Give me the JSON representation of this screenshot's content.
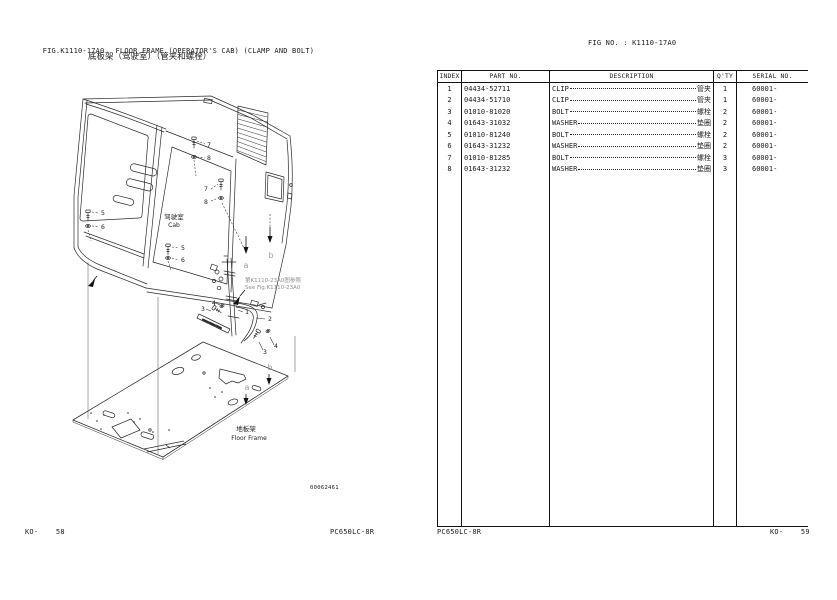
{
  "header": {
    "fig_label": "FIG.K1110-17A0",
    "title_en": "FLOOR FRAME (OPERATOR'S CAB) (CLAMP AND BOLT)",
    "title_zh": "底板架（驾驶室）（管夹和螺栓）",
    "fig_no": "FIG NO. : K1110-17A0"
  },
  "table": {
    "columns": [
      "INDEX",
      "PART NO.",
      "DESCRIPTION",
      "Q'TY",
      "SERIAL NO."
    ],
    "rows": [
      {
        "index": "1",
        "part_no": "04434-52711",
        "desc_en": "CLIP",
        "desc_zh": "管夹",
        "qty": "1",
        "serial": "60001-"
      },
      {
        "index": "2",
        "part_no": "04434-51710",
        "desc_en": "CLIP",
        "desc_zh": "管夹",
        "qty": "1",
        "serial": "60001-"
      },
      {
        "index": "3",
        "part_no": "01010-81020",
        "desc_en": "BOLT",
        "desc_zh": "螺栓",
        "qty": "2",
        "serial": "60001-"
      },
      {
        "index": "4",
        "part_no": "01643-31032",
        "desc_en": "WASHER",
        "desc_zh": "垫圈",
        "qty": "2",
        "serial": "60001-"
      },
      {
        "index": "5",
        "part_no": "01010-81240",
        "desc_en": "BOLT",
        "desc_zh": "螺栓",
        "qty": "2",
        "serial": "60001-"
      },
      {
        "index": "6",
        "part_no": "01643-31232",
        "desc_en": "WASHER",
        "desc_zh": "垫圈",
        "qty": "2",
        "serial": "60001-"
      },
      {
        "index": "7",
        "part_no": "01010-81285",
        "desc_en": "BOLT",
        "desc_zh": "螺栓",
        "qty": "3",
        "serial": "60001-"
      },
      {
        "index": "8",
        "part_no": "01643-31232",
        "desc_en": "WASHER",
        "desc_zh": "垫圈",
        "qty": "3",
        "serial": "60001-"
      }
    ]
  },
  "diagram": {
    "cab_label_zh": "驾驶室",
    "cab_label_en": "Cab",
    "ref_note_zh": "第K1110-23A0图参照",
    "ref_note_en": "See Fig.K1110-23A0",
    "floor_label_zh": "地板架",
    "floor_label_en": "Floor Frame",
    "drawing_no": "00062461",
    "callouts": {
      "n1": "1",
      "n2": "2",
      "n3": "3",
      "n4": "4",
      "n5": "5",
      "n6": "6",
      "n7": "7",
      "n8": "8",
      "a": "a",
      "b": "b"
    }
  },
  "footer": {
    "left_page": "KO-    58",
    "left_model": "PC650LC-8R",
    "right_model": "PC650LC-8R",
    "right_page": "KO-    59"
  }
}
